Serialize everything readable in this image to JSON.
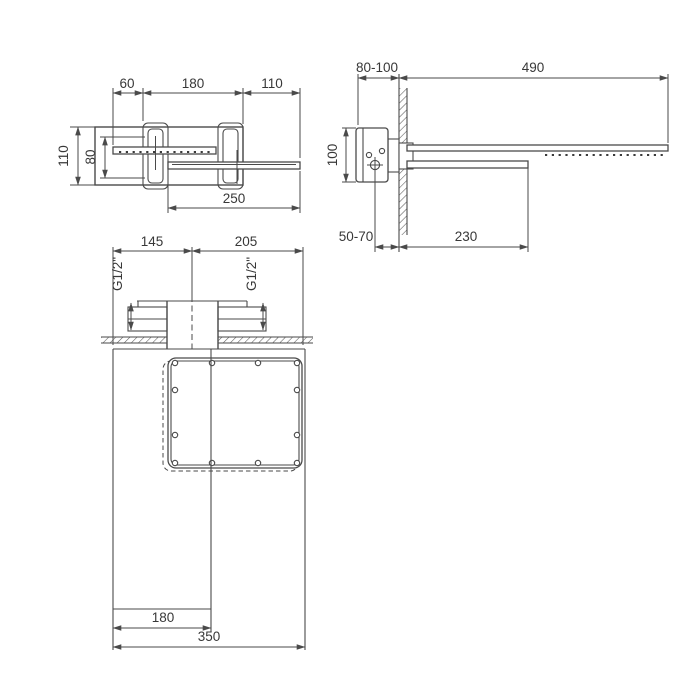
{
  "drawing": {
    "type": "technical-dimension-drawing",
    "subject": "wall-mounted waterfall and rain shower head, three orthographic views",
    "colors": {
      "background": "#ffffff",
      "line": "#4a4a4a",
      "text": "#383838"
    },
    "front": {
      "d60": "60",
      "d180": "180",
      "d110_top": "110",
      "d110_left": "110",
      "d80": "80",
      "d250": "250"
    },
    "side": {
      "d80_100": "80-100",
      "d490": "490",
      "d100": "100",
      "d50_70": "50-70",
      "d230": "230"
    },
    "plan": {
      "d145": "145",
      "d205": "205",
      "g_left": "G1/2\"",
      "g_right": "G1/2\"",
      "d180": "180",
      "d350": "350"
    }
  }
}
